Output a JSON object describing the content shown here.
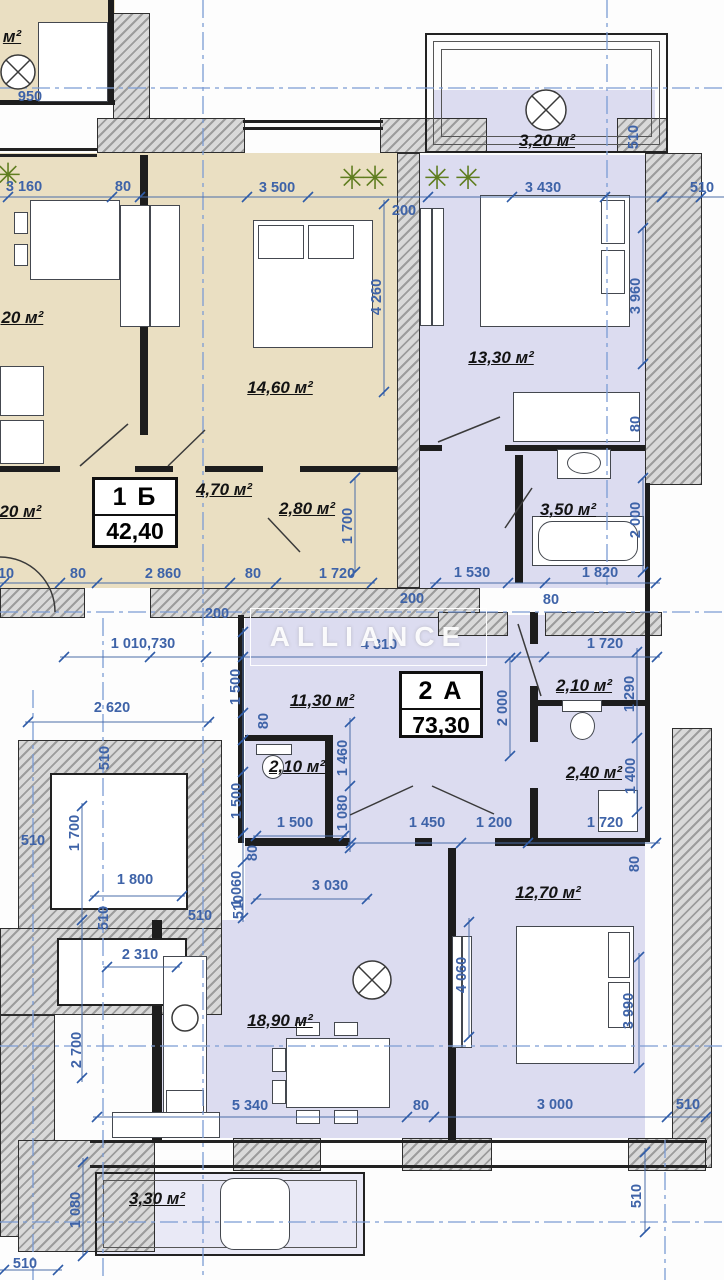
{
  "watermark": {
    "text": "ALLIANCE"
  },
  "apartments": [
    {
      "code": "1 Б",
      "area": "42,40"
    },
    {
      "code": "2 А",
      "area": "73,30"
    }
  ],
  "rooms": {
    "labels": [
      "3,20 м²",
      "14,60 м²",
      "13,30 м²",
      "4,70 м²",
      "2,80 м²",
      "3,50 м²",
      "11,30 м²",
      "2,10 м²",
      "2,10 м²",
      "2,40 м²",
      "12,70 м²",
      "18,90 м²",
      "3,30 м²",
      ",20 м²",
      ",20 м²",
      "м²"
    ]
  },
  "dims": {
    "labels": [
      "950",
      "3 160",
      "80",
      "3 500",
      "3 430",
      "510",
      "510",
      "200",
      "4 260",
      "3 960",
      "80",
      "1 700",
      "2 000",
      "510",
      "80",
      "2 860",
      "80",
      "1 720",
      "1 530",
      "1 820",
      "200",
      "80",
      "200",
      "1 010,730",
      "4 310",
      "1 720",
      "1 500",
      "2 620",
      "2 000",
      "1 290",
      "80",
      "1 460",
      "510",
      "1 500",
      "1 080",
      "1 400",
      "1 500",
      "1 450",
      "1 200",
      "1 720",
      "510",
      "1 700",
      "80",
      "3 030",
      "1 060",
      "80",
      "1 800",
      "510",
      "510",
      "510",
      "2 310",
      "4 060",
      "2 700",
      "3 990",
      "5 340",
      "80",
      "3 000",
      "510",
      "1 080",
      "510",
      "510"
    ]
  },
  "colors": {
    "beige_room": "#eadfc2",
    "lavender_room": "#dcdcf0",
    "dimension_blue": "#3e63a8",
    "axis_blue": "#7b9cd4",
    "wall_dark": "#1d1d1d",
    "plant_green": "#5f7d1f"
  },
  "icons": {
    "plant_glyph": "✳"
  }
}
